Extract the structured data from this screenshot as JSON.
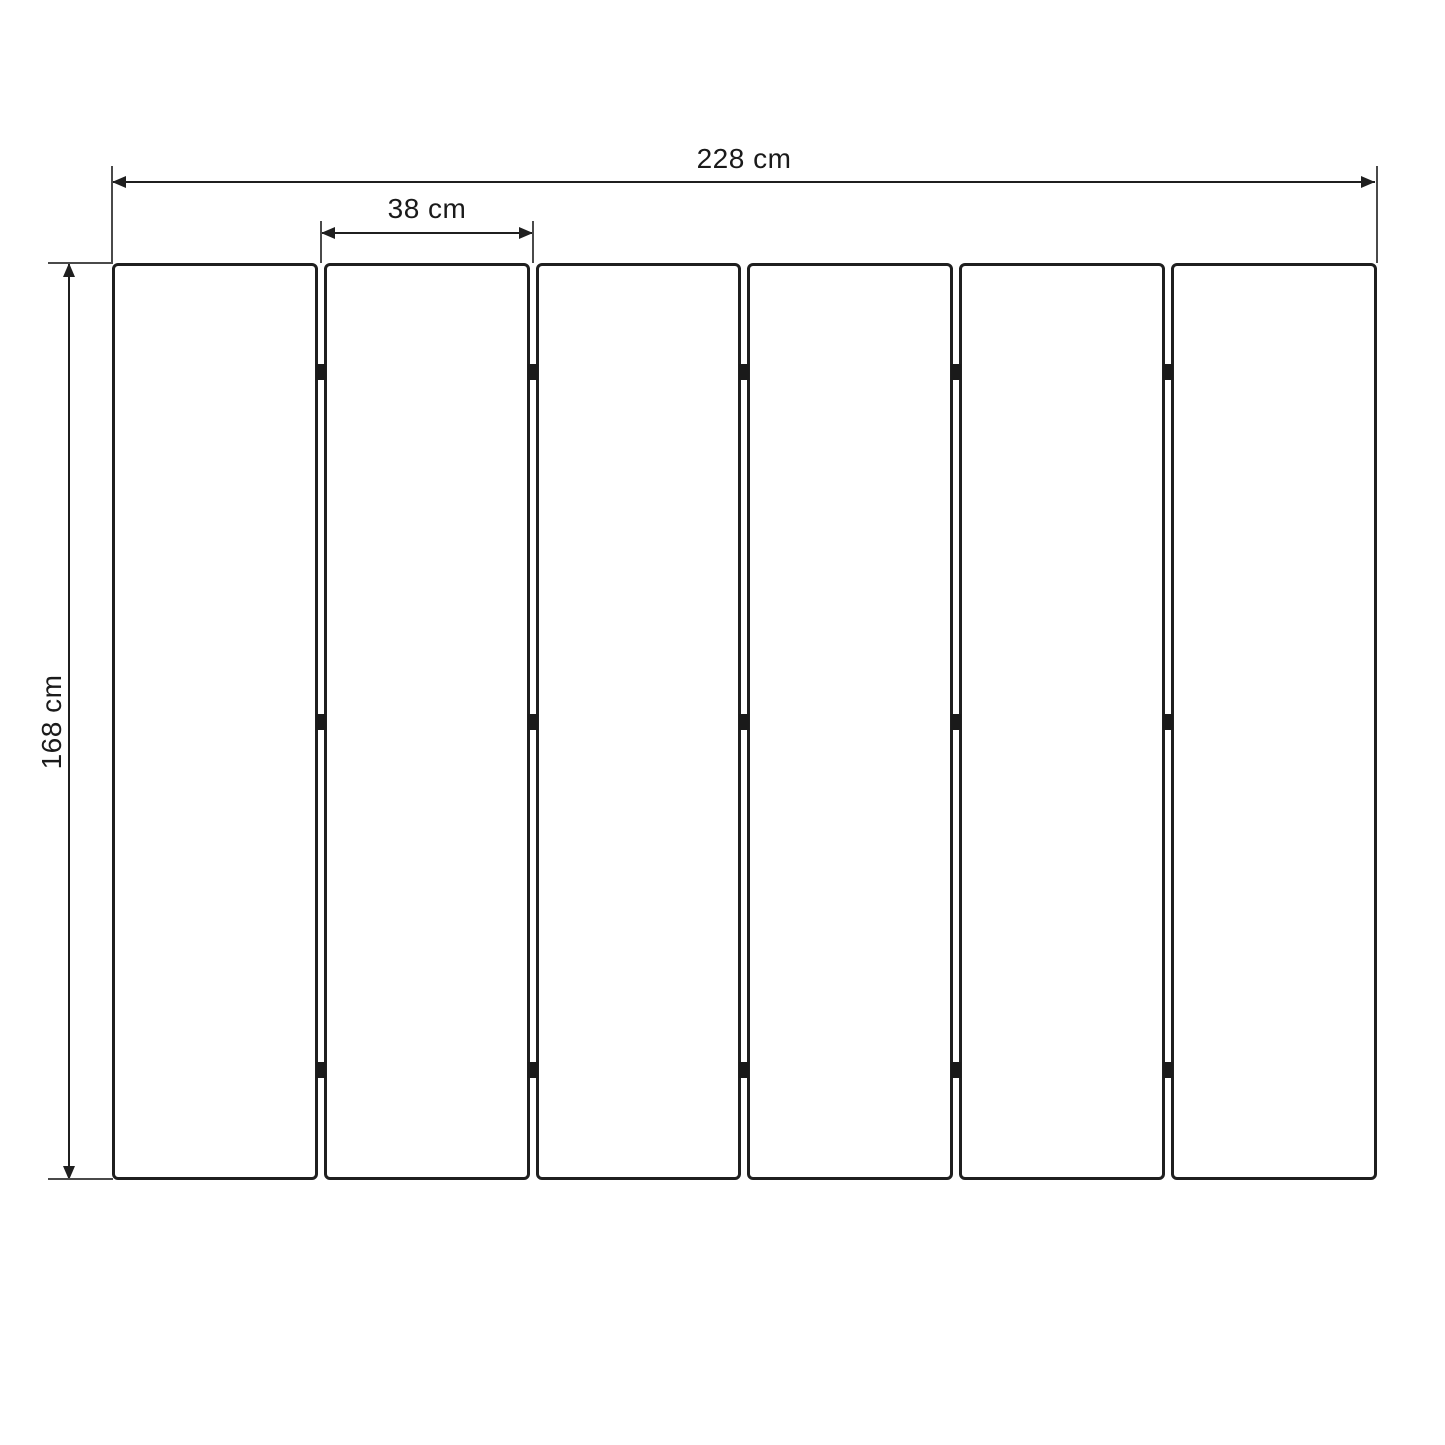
{
  "diagram": {
    "type": "dimension-drawing",
    "dimensions": {
      "total_width": {
        "label": "228 cm",
        "value": 228,
        "unit": "cm"
      },
      "panel_width": {
        "label": "38 cm",
        "value": 38,
        "unit": "cm"
      },
      "height": {
        "label": "168 cm",
        "value": 168,
        "unit": "cm"
      }
    },
    "panels": {
      "count": 6,
      "gap_count": 5,
      "hinges_per_gap": 3
    },
    "colors": {
      "line": "#1f1f1f",
      "text": "#1a1a1a",
      "background": "#ffffff"
    }
  }
}
